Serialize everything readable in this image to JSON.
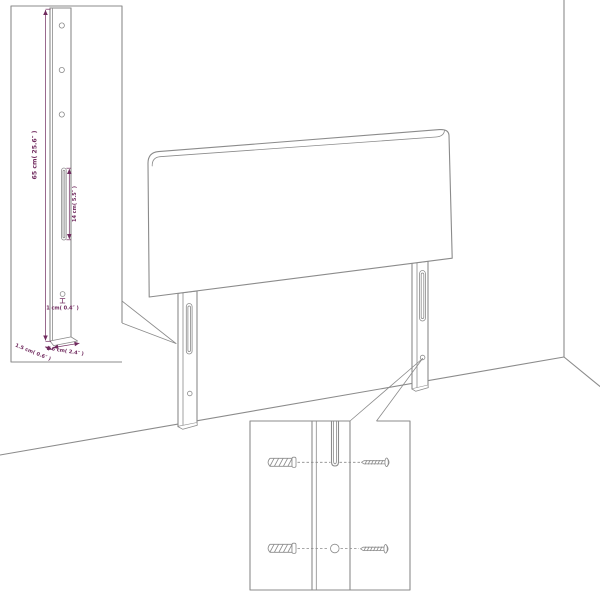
{
  "diagram": {
    "description": "Headboard wall-mount assembly diagram with leg side-view dimension inset and mounting hardware detail inset",
    "colors": {
      "background": "#ffffff",
      "line": "#8b8b8b",
      "dimension": "#702a5e"
    },
    "insets": {
      "leg_side_view": {
        "dimensions": {
          "height": "65 cm( 25.6″ )",
          "slot_length": "14 cm( 5.5″ )",
          "hole_offset": "1 cm( 0.4″ )",
          "thickness": "1.5 cm( 0.6″ )",
          "width": "6 cm( 2.4″ )"
        }
      },
      "mounting_detail": {
        "hardware": [
          "wall-plug",
          "screw",
          "wall-plug",
          "screw"
        ]
      }
    }
  }
}
